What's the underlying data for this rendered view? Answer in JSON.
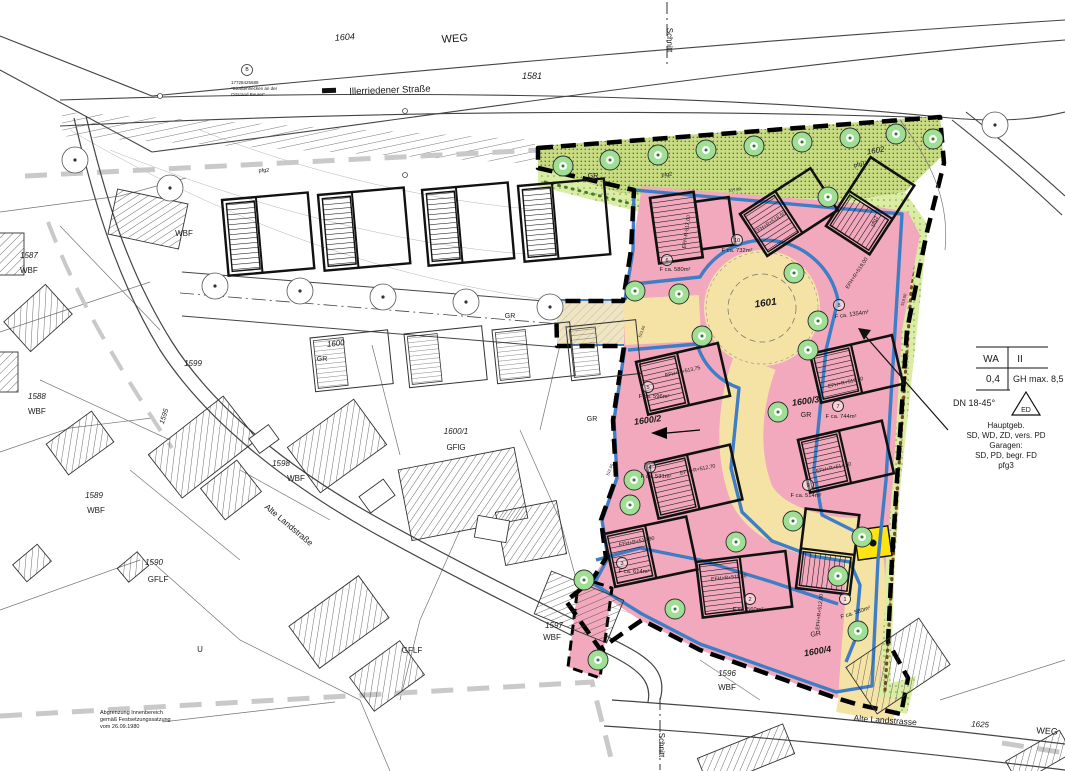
{
  "title": "Bebauungsplan Lageplan – Illerriedener Straße / Alte Landstraße",
  "colors": {
    "parcel_pink": "#F2A9BD",
    "road_yellow": "#F5E3A6",
    "trafo_yellow": "#FFE40F",
    "green_planting_dark": "#C9DC84",
    "green_planting_light": "#DBEDA4",
    "tree_green": "#9FDF94",
    "baugrenze_blue": "#3E7EC6",
    "boundary_black": "#000000",
    "innenbereich_gray": "#C9C9C9",
    "hedge_brown": "#7A4A1E"
  },
  "legend": {
    "use": "WA",
    "storeys": "II",
    "grz": "0,4",
    "gh": "GH max. 8,5",
    "roof_pitch": "DN 18-45°",
    "roof_symbol": "ED",
    "notes": [
      "Hauptgeb.",
      "SD, WD, ZD, vers. PD",
      "Garagen:",
      "SD, PD, begr. FD",
      "pfg3"
    ]
  },
  "note_bottom_left": [
    "Abgrenzung Innenbereich",
    "gemäß Festsetzungssatzung",
    "vom 26.09.1980"
  ],
  "labels": [
    [
      "WEG",
      455,
      42,
      11,
      -4,
      "",
      ""
    ],
    [
      "1604",
      345,
      40,
      9,
      -4,
      "i",
      ""
    ],
    [
      "1581",
      532,
      79,
      9,
      0,
      "i",
      ""
    ],
    [
      "Illerriedener Straße",
      390,
      93,
      9.5,
      -2,
      "",
      ""
    ],
    [
      "17728425688",
      231,
      84,
      4.5,
      0,
      "",
      "start"
    ],
    [
      "\"Straßenhecken an der",
      231,
      90,
      4.5,
      0,
      "",
      "start"
    ],
    [
      "Ortsrand Beurer\"",
      231,
      96,
      4.5,
      0,
      "",
      "start"
    ],
    [
      "Schnitt",
      667,
      40,
      8,
      90,
      "",
      ""
    ],
    [
      "Schnitt",
      659,
      745,
      8,
      90,
      "",
      ""
    ],
    [
      "1602",
      876,
      153,
      8,
      -10,
      "i",
      ""
    ],
    [
      "pfg1",
      860,
      166,
      6,
      -15,
      "",
      ""
    ],
    [
      "pfg2",
      667,
      176,
      5.5,
      -5,
      "",
      ""
    ],
    [
      "pfg2",
      264,
      172,
      5.5,
      -3,
      "",
      ""
    ],
    [
      "pfg2",
      876,
      222,
      5.5,
      -65,
      "",
      ""
    ],
    [
      "GR",
      593,
      178,
      7,
      0,
      "",
      ""
    ],
    [
      "GR",
      510,
      318,
      7,
      0,
      "",
      ""
    ],
    [
      "GR",
      322,
      361,
      7,
      0,
      "",
      ""
    ],
    [
      "GR",
      592,
      421,
      7,
      0,
      "",
      ""
    ],
    [
      "GR",
      806,
      417,
      7,
      0,
      "",
      ""
    ],
    [
      "GR",
      816,
      636,
      7,
      -10,
      "",
      ""
    ],
    [
      "WBF",
      184,
      236,
      8,
      0,
      "",
      ""
    ],
    [
      "1587",
      20,
      258,
      8,
      0,
      "i",
      "start"
    ],
    [
      "WBF",
      20,
      273,
      8,
      0,
      "",
      "start"
    ],
    [
      "1588",
      28,
      399,
      8,
      0,
      "i",
      "start"
    ],
    [
      "WBF",
      28,
      414,
      8,
      0,
      "",
      "start"
    ],
    [
      "1589",
      94,
      498,
      8,
      0,
      "i",
      ""
    ],
    [
      "WBF",
      96,
      513,
      8,
      0,
      "",
      ""
    ],
    [
      "1590",
      154,
      565,
      8,
      0,
      "i",
      ""
    ],
    [
      "GFLF",
      158,
      582,
      8,
      0,
      "",
      ""
    ],
    [
      "1599",
      193,
      366,
      8,
      0,
      "i",
      ""
    ],
    [
      "1598",
      281,
      466,
      8,
      0,
      "i",
      ""
    ],
    [
      "WBF",
      296,
      481,
      8,
      0,
      "",
      ""
    ],
    [
      "1600",
      336,
      346,
      8,
      -6,
      "i",
      ""
    ],
    [
      "1600/1",
      456,
      434,
      8,
      0,
      "i",
      ""
    ],
    [
      "GFlG",
      456,
      450,
      8,
      0,
      "",
      ""
    ],
    [
      "1597",
      554,
      628,
      8,
      0,
      "i",
      ""
    ],
    [
      "WBF",
      552,
      640,
      8,
      0,
      "",
      ""
    ],
    [
      "U",
      200,
      652,
      8,
      0,
      "",
      ""
    ],
    [
      "GFLF",
      412,
      653,
      8,
      0,
      "",
      ""
    ],
    [
      "1596",
      727,
      676,
      8,
      0,
      "i",
      ""
    ],
    [
      "WBF",
      727,
      690,
      8,
      0,
      "",
      ""
    ],
    [
      "1595",
      166,
      417,
      7,
      -72,
      "i",
      ""
    ],
    [
      "Alte Landstraße",
      287,
      527,
      8.5,
      40,
      "",
      ""
    ],
    [
      "Alte Landstrasse",
      885,
      723,
      8.5,
      4,
      "",
      ""
    ],
    [
      "1625",
      980,
      727,
      8,
      3,
      "i",
      ""
    ],
    [
      "WEG",
      1047,
      734,
      9,
      3,
      "",
      ""
    ],
    [
      "1601",
      766,
      306,
      10,
      -8,
      "bi",
      ""
    ],
    [
      "1600/2",
      648,
      423,
      9,
      -8,
      "bi",
      ""
    ],
    [
      "1600/3",
      806,
      404,
      9,
      -8,
      "bi",
      ""
    ],
    [
      "1600/4",
      818,
      654,
      9,
      -10,
      "bi",
      ""
    ],
    [
      "517,00",
      735,
      191,
      4,
      -8,
      "",
      ""
    ],
    [
      "513,00",
      643,
      332,
      4,
      -70,
      "",
      ""
    ],
    [
      "512,00",
      611,
      470,
      4,
      -70,
      "",
      ""
    ],
    [
      "519,00",
      905,
      300,
      4,
      -75,
      "",
      ""
    ],
    [
      "WA",
      991,
      362,
      10,
      0,
      "",
      ""
    ],
    [
      "II",
      1020,
      362,
      10,
      0,
      "",
      ""
    ],
    [
      "0,4",
      993,
      382,
      10,
      0,
      "",
      ""
    ],
    [
      "GH max. 8,5",
      1013,
      382,
      9,
      0,
      "",
      "start"
    ],
    [
      "DN 18-45°",
      953,
      406,
      9,
      0,
      "",
      "start"
    ],
    [
      "ED",
      1026,
      412,
      7,
      0,
      "",
      ""
    ],
    [
      "Hauptgeb.",
      1006,
      428,
      8,
      0,
      "",
      ""
    ],
    [
      "SD, WD, ZD, vers. PD",
      1006,
      438,
      8,
      0,
      "",
      ""
    ],
    [
      "Garagen:",
      1006,
      448,
      8,
      0,
      "",
      ""
    ],
    [
      "SD, PD, begr. FD",
      1006,
      458,
      8,
      0,
      "",
      ""
    ],
    [
      "pfg3",
      1006,
      468,
      8,
      0,
      "",
      ""
    ],
    [
      "Abgrenzung Innenbereich",
      100,
      714,
      5.5,
      0,
      "",
      "start"
    ],
    [
      "gemäß Festsetzungssatzung",
      100,
      721,
      5.5,
      0,
      "",
      "start"
    ],
    [
      "vom 26.09.1980",
      100,
      728,
      5.5,
      0,
      "",
      "start"
    ],
    [
      "B",
      247,
      71,
      5,
      0,
      "",
      ""
    ]
  ],
  "buildings": [
    [
      "EFH-R-517,00",
      688,
      232,
      -82
    ],
    [
      "EFH+R+518,50",
      771,
      224,
      -33
    ],
    [
      "EFH+R+519,00",
      858,
      274,
      -57
    ],
    [
      "EFH+R+513,75",
      683,
      373,
      -13
    ],
    [
      "EFH+R+519,50",
      846,
      384,
      -13
    ],
    [
      "EFH+R+512,70",
      698,
      471,
      -12
    ],
    [
      "EFH+R+514,50",
      834,
      469,
      -12
    ],
    [
      "EFH+R+510,90",
      637,
      543,
      -11
    ],
    [
      "EFH+R+511,50",
      729,
      579,
      -6
    ],
    [
      "EFH+R+512,00",
      821,
      612,
      -84
    ]
  ],
  "parcels": [
    [
      "1",
      845,
      599,
      "F ca. 580m²",
      856,
      614,
      -18
    ],
    [
      "2",
      750,
      599,
      "F ca. 560m²",
      748,
      611,
      0
    ],
    [
      "3",
      622,
      563,
      "F ca. 614m²",
      634,
      573,
      0
    ],
    [
      "4",
      650,
      467,
      "F ca. 531m²",
      656,
      478,
      0
    ],
    [
      "5",
      648,
      387,
      "F ca. 596m²",
      654,
      398,
      0
    ],
    [
      "6",
      667,
      260,
      "F ca. 580m²",
      675,
      271,
      0
    ],
    [
      "7",
      838,
      406,
      "F ca. 744m²",
      841,
      418,
      0
    ],
    [
      "8",
      839,
      305,
      "F ca. 1354m²",
      852,
      316,
      -8
    ],
    [
      "9",
      808,
      485,
      "F ca. 514m²",
      806,
      497,
      0
    ],
    [
      "10",
      737,
      240,
      "F ca. 732m²",
      737,
      252,
      0
    ]
  ],
  "trees_planned": [
    [
      563,
      166
    ],
    [
      610,
      160
    ],
    [
      658,
      155
    ],
    [
      706,
      150
    ],
    [
      754,
      146
    ],
    [
      802,
      142
    ],
    [
      850,
      138
    ],
    [
      896,
      134
    ],
    [
      933,
      139
    ],
    [
      828,
      197
    ],
    [
      794,
      273
    ],
    [
      818,
      321
    ],
    [
      635,
      291
    ],
    [
      679,
      294
    ],
    [
      702,
      336
    ],
    [
      808,
      350
    ],
    [
      778,
      412
    ],
    [
      634,
      480
    ],
    [
      630,
      505
    ],
    [
      584,
      580
    ],
    [
      598,
      660
    ],
    [
      675,
      609
    ],
    [
      736,
      542
    ],
    [
      793,
      521
    ],
    [
      862,
      537
    ],
    [
      838,
      576
    ],
    [
      858,
      631
    ]
  ],
  "trees_existing": [
    [
      215,
      286
    ],
    [
      300,
      291
    ],
    [
      383,
      297
    ],
    [
      466,
      302
    ],
    [
      550,
      307
    ],
    [
      75,
      160
    ],
    [
      170,
      188
    ],
    [
      995,
      125
    ]
  ]
}
